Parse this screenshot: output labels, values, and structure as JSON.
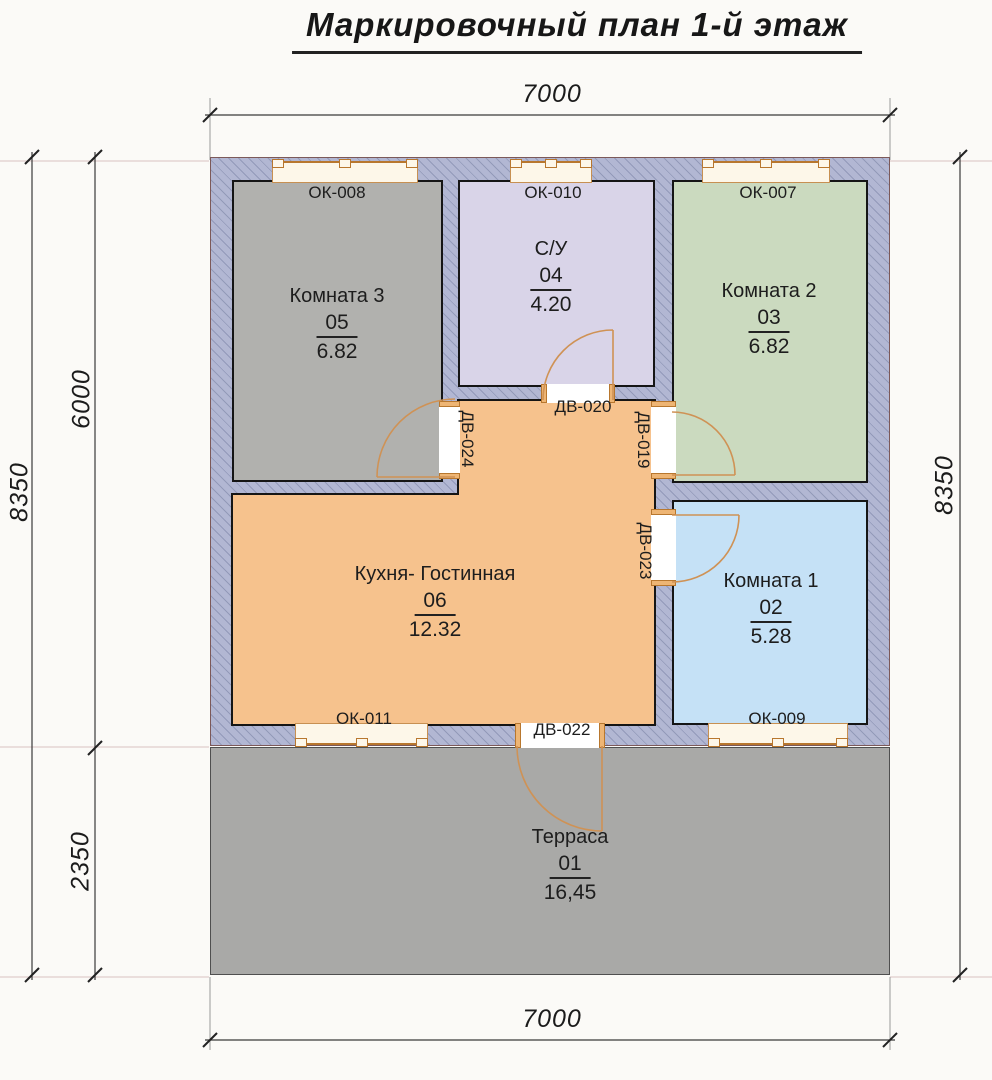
{
  "title": "Маркировочный план 1-й этаж",
  "dimensions": {
    "top": "7000",
    "bottom": "7000",
    "left_total": "8350",
    "left_main": "6000",
    "left_terrace": "2350",
    "right_total": "8350"
  },
  "rooms": [
    {
      "name": "Комната 3",
      "number": "05",
      "area": "6.82",
      "fill": "#b1b1ae"
    },
    {
      "name": "С/У",
      "number": "04",
      "area": "4.20",
      "fill": "#d9d4e8"
    },
    {
      "name": "Комната 2",
      "number": "03",
      "area": "6.82",
      "fill": "#cbdabf"
    },
    {
      "name": "Кухня- Гостинная",
      "number": "06",
      "area": "12.32",
      "fill": "#f6c28d"
    },
    {
      "name": "Комната 1",
      "number": "02",
      "area": "5.28",
      "fill": "#c5e1f6"
    },
    {
      "name": "Терраса",
      "number": "01",
      "area": "16,45",
      "fill": "#a9a9a7"
    }
  ],
  "windows": [
    {
      "label": "ОК-008"
    },
    {
      "label": "ОК-010"
    },
    {
      "label": "ОК-007"
    },
    {
      "label": "ОК-011"
    },
    {
      "label": "ОК-009"
    }
  ],
  "doors": [
    {
      "label": "ДВ-020"
    },
    {
      "label": "ДВ-024"
    },
    {
      "label": "ДВ-019"
    },
    {
      "label": "ДВ-023"
    },
    {
      "label": "ДВ-022"
    }
  ],
  "colors": {
    "wall": "#b2b7d3",
    "wall_outline": "#7c5959",
    "inner_line": "#151515",
    "window_frame": "#b8772e",
    "window_fill": "#fdf7e9",
    "door_swing": "#cf9255",
    "dimension_line": "#3a3a3a",
    "guide_line": "#d9c2c0",
    "background": "#fbfaf7"
  }
}
